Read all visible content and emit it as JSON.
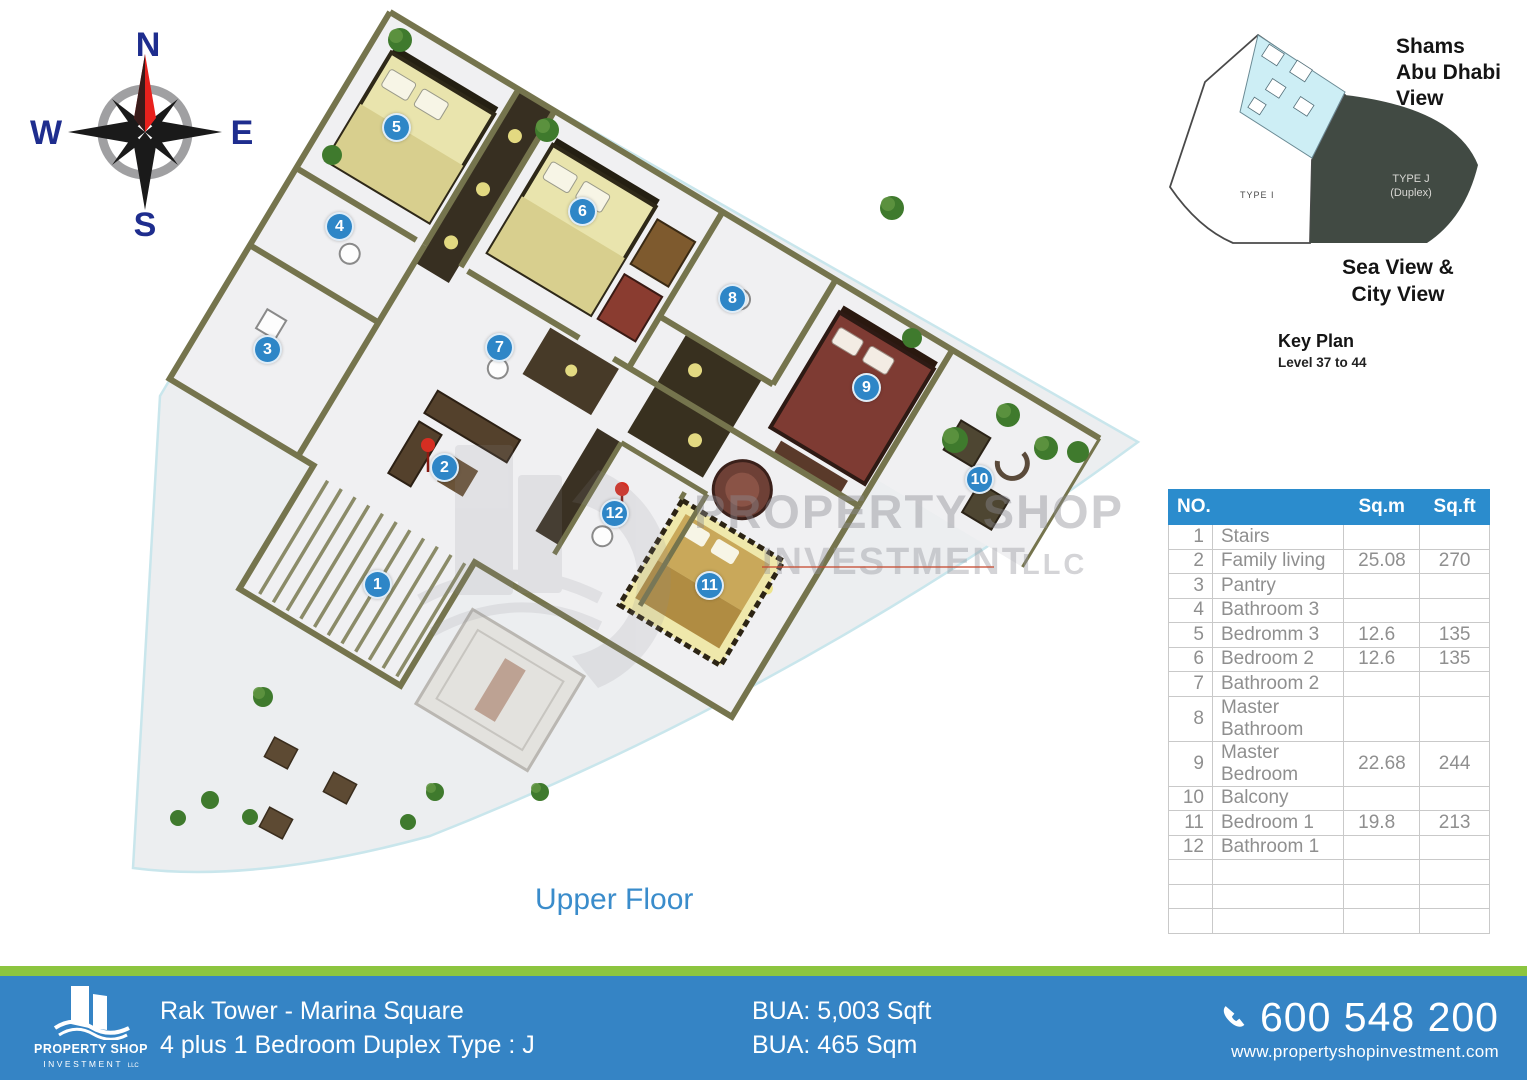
{
  "plan": {
    "floor_label": "Upper Floor",
    "markers": [
      {
        "no": "1",
        "x": 378,
        "y": 585
      },
      {
        "no": "2",
        "x": 445,
        "y": 468
      },
      {
        "no": "3",
        "x": 268,
        "y": 350
      },
      {
        "no": "4",
        "x": 340,
        "y": 227
      },
      {
        "no": "5",
        "x": 397,
        "y": 128
      },
      {
        "no": "6",
        "x": 583,
        "y": 212
      },
      {
        "no": "7",
        "x": 500,
        "y": 348
      },
      {
        "no": "8",
        "x": 733,
        "y": 299
      },
      {
        "no": "9",
        "x": 867,
        "y": 388
      },
      {
        "no": "10",
        "x": 980,
        "y": 480
      },
      {
        "no": "11",
        "x": 710,
        "y": 586
      },
      {
        "no": "12",
        "x": 615,
        "y": 514
      }
    ]
  },
  "compass": {
    "north": "N",
    "south": "S",
    "east": "E",
    "west": "W"
  },
  "key_plan": {
    "view_top": "Shams\nAbu Dhabi\nView",
    "view_bottom": "Sea View &\nCity View",
    "title": "Key Plan",
    "subtitle": "Level 37 to 44",
    "type_i_label": "TYPE I",
    "type_j_label": "TYPE J\n(Duplex)"
  },
  "watermark": {
    "line1": "PROPERTY SHOP",
    "line2": "INVESTMENT",
    "line3": "LLC"
  },
  "room_table": {
    "header_no": "NO.",
    "header_name": "",
    "header_sqm": "Sq.m",
    "header_sqft": "Sq.ft",
    "rows": [
      {
        "no": "1",
        "name": "Stairs",
        "sqm": "",
        "sqft": ""
      },
      {
        "no": "2",
        "name": "Family living",
        "sqm": "25.08",
        "sqft": "270"
      },
      {
        "no": "3",
        "name": "Pantry",
        "sqm": "",
        "sqft": ""
      },
      {
        "no": "4",
        "name": "Bathroom 3",
        "sqm": "",
        "sqft": ""
      },
      {
        "no": "5",
        "name": "Bedromm 3",
        "sqm": "12.6",
        "sqft": "135"
      },
      {
        "no": "6",
        "name": "Bedroom 2",
        "sqm": "12.6",
        "sqft": "135"
      },
      {
        "no": "7",
        "name": "Bathroom 2",
        "sqm": "",
        "sqft": ""
      },
      {
        "no": "8",
        "name": "Master Bathroom",
        "sqm": "",
        "sqft": ""
      },
      {
        "no": "9",
        "name": "Master Bedroom",
        "sqm": "22.68",
        "sqft": "244"
      },
      {
        "no": "10",
        "name": "Balcony",
        "sqm": "",
        "sqft": ""
      },
      {
        "no": "11",
        "name": "Bedroom 1",
        "sqm": "19.8",
        "sqft": "213"
      },
      {
        "no": "12",
        "name": "Bathroom 1",
        "sqm": "",
        "sqft": ""
      }
    ],
    "empty_rows": 3
  },
  "footer": {
    "logo_line1": "PROPERTY SHOP",
    "logo_line2": "INVESTMENT",
    "logo_llc": "LLC",
    "project": "Rak Tower - Marina Square",
    "unit_type": "4 plus 1 Bedroom Duplex Type : J",
    "bua_sqft": "BUA: 5,003 Sqft",
    "bua_sqm": "BUA: 465 Sqm",
    "phone": "600 548 200",
    "website": "www.propertyshopinvestment.com"
  },
  "colors": {
    "footer_blue": "#3584c5",
    "footer_green": "#8cc53f",
    "table_header_blue": "#2b8ccd",
    "marker_blue": "#2e86c7",
    "title_blue": "#3a8ccb",
    "wall_olive": "#75744d",
    "keyplan_dark": "#414a43",
    "keyplan_cyan": "#cdeef5",
    "compass_navy": "#1e2d8e",
    "compass_red": "#e8211d"
  }
}
